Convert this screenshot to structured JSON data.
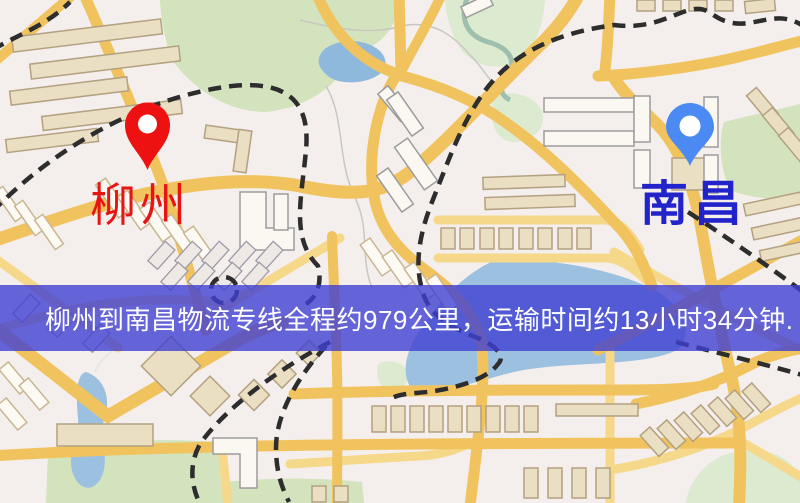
{
  "map": {
    "origin": {
      "label": "柳州",
      "label_color": "#e81414",
      "pin_color": "#ee1111"
    },
    "destination": {
      "label": "南昌",
      "label_color": "#2323cb",
      "pin_color": "#4a8af2"
    }
  },
  "banner": {
    "text": "柳州到南昌物流专线全程约979公里，运输时间约13小时34分钟.",
    "distance": "979公里",
    "duration": "13小时34分钟",
    "background_color": "rgba(64,64,210,0.8)",
    "text_color": "#ffffff"
  }
}
